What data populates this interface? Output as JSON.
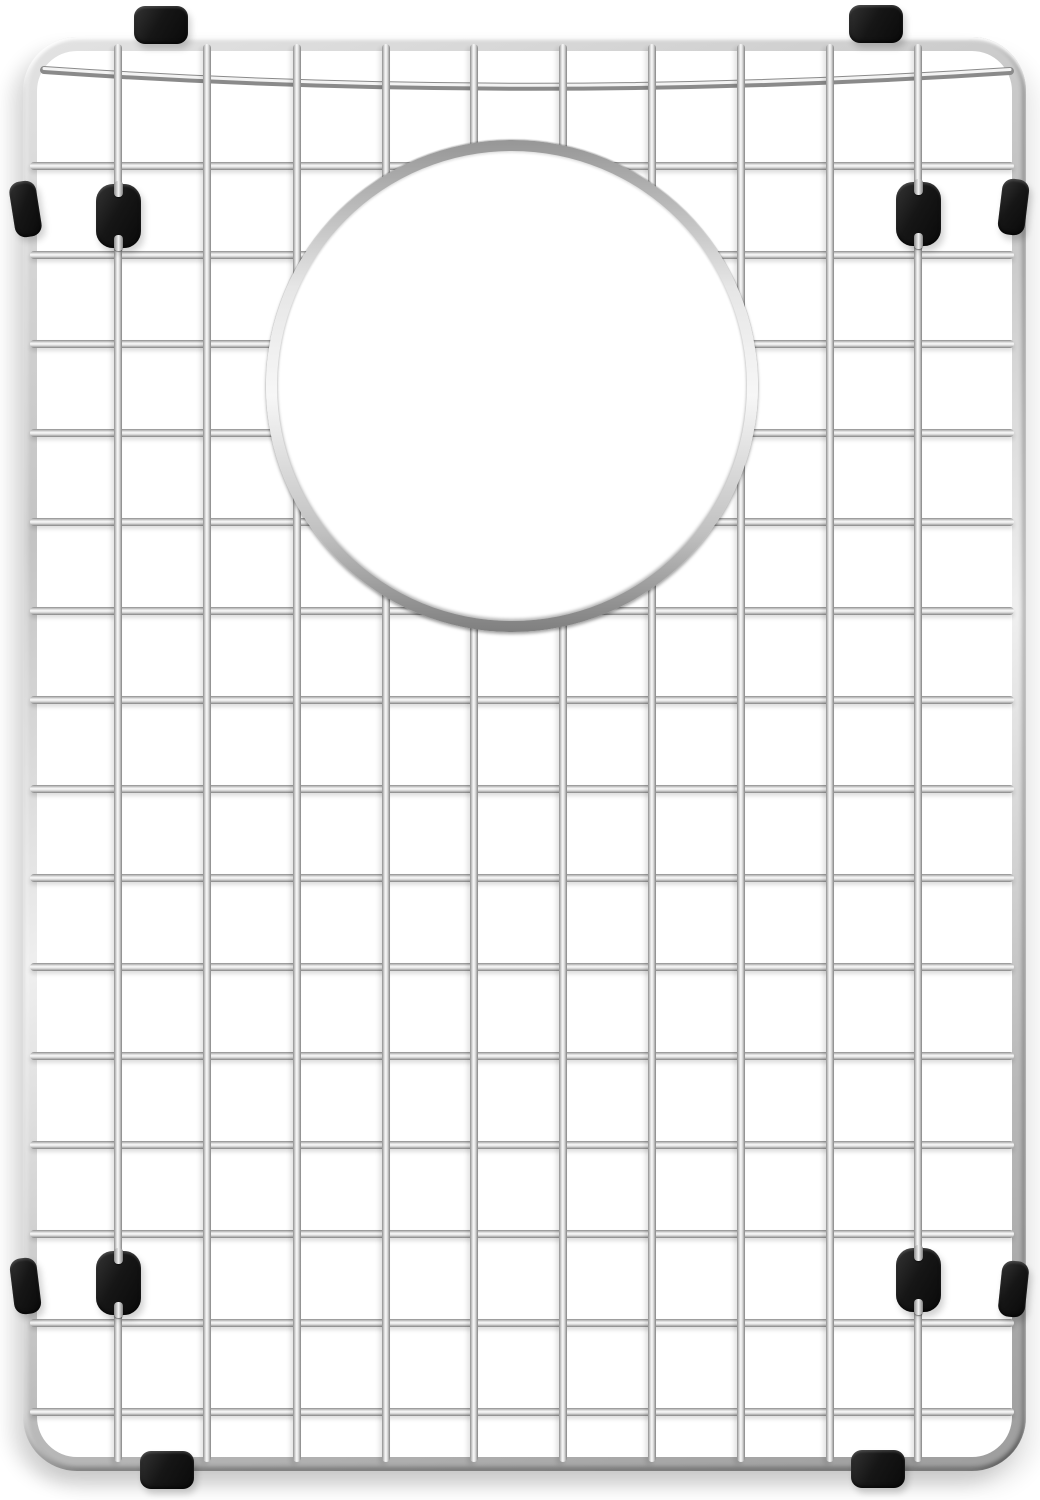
{
  "image": {
    "kind": "product-photo",
    "subject": "stainless-steel-sink-bottom-grid-with-drain-opening-and-black-rubber-feet",
    "background_color": "#ffffff",
    "metal_color": "#d9d9d9",
    "rubber_color": "#141414"
  },
  "scene": {
    "canvas": {
      "width": 1040,
      "height": 1500
    },
    "frame": {
      "x": 23,
      "y": 37,
      "width": 1003,
      "height": 1434,
      "radius": 54,
      "tube": 14
    },
    "wires": {
      "thickness": 8,
      "horizontal_y": [
        166,
        255,
        344,
        433,
        522,
        611,
        700,
        789,
        878,
        967,
        1056,
        1145,
        1234,
        1323,
        1412
      ],
      "horizontal_span": [
        30,
        1014
      ],
      "vertical_x": [
        118,
        207,
        297,
        386,
        474,
        563,
        652,
        741,
        830,
        918
      ],
      "vertical_span": [
        44,
        1462
      ],
      "sag_wire": {
        "x1": 44,
        "y1": 70,
        "cx": 520,
        "cy": 103,
        "x2": 1010,
        "y2": 71
      }
    },
    "drain_ring": {
      "cx": 512,
      "cy": 386,
      "outer_diameter": 492,
      "band": 11
    },
    "rubber": {
      "clip_size": {
        "w": 54,
        "h": 38,
        "r": 11
      },
      "top_clips": [
        {
          "cx": 161,
          "cy": 25
        },
        {
          "cx": 876,
          "cy": 24
        }
      ],
      "bottom_clips": [
        {
          "cx": 167,
          "cy": 1470
        },
        {
          "cx": 878,
          "cy": 1469
        }
      ],
      "bumper_size": {
        "w": 27,
        "h": 56,
        "r": 11
      },
      "side_bumpers": [
        {
          "cx": 25,
          "cy": 209,
          "rot": -9
        },
        {
          "cx": 1013,
          "cy": 207,
          "rot": 7
        },
        {
          "cx": 25,
          "cy": 1286,
          "rot": -7
        },
        {
          "cx": 1013,
          "cy": 1289,
          "rot": 6
        }
      ],
      "foot_size": {
        "w": 45,
        "h": 64,
        "r": 17
      },
      "feet": [
        {
          "cx": 118,
          "cy": 216
        },
        {
          "cx": 918,
          "cy": 214
        },
        {
          "cx": 118,
          "cy": 1283
        },
        {
          "cx": 918,
          "cy": 1280
        }
      ],
      "notch": {
        "w": 9,
        "h": 16,
        "r": 4
      }
    }
  }
}
